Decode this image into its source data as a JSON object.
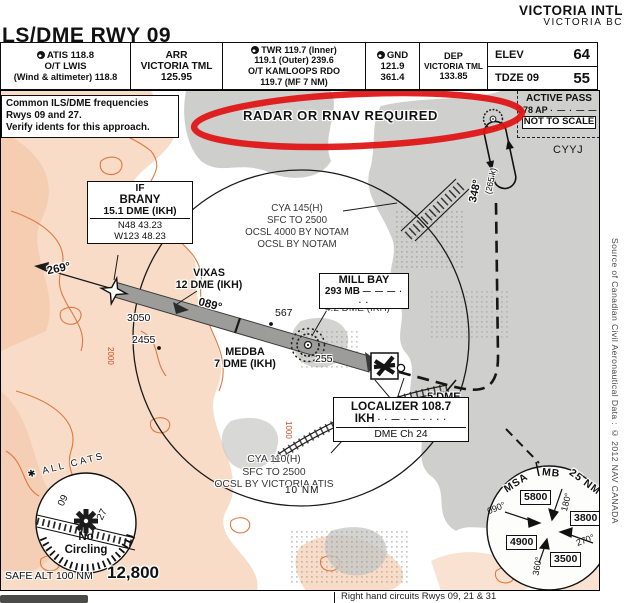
{
  "colors": {
    "terrain": "#f8dcc7",
    "terrain_contour": "#df7940",
    "water": "#c8c8c6",
    "annotation_red": "#e01212",
    "ink": "#111111"
  },
  "header": {
    "airport": "VICTORIA INTL",
    "city": "VICTORIA BC",
    "title": "LS/DME RWY 09",
    "atis": [
      "ATIS 118.8",
      "O/T LWIS",
      "(Wind & altimeter) 118.8"
    ],
    "arr": [
      "ARR",
      "VICTORIA TML",
      "125.95"
    ],
    "twr": [
      "TWR  119.7 (Inner)",
      "119.1 (Outer)  239.6",
      "O/T KAMLOOPS RDO",
      "119.7 (MF 7 NM)"
    ],
    "gnd": [
      "GND",
      "121.9",
      "361.4"
    ],
    "dep": [
      "DEP",
      "VICTORIA TML",
      "133.85"
    ],
    "elev_label": "ELEV",
    "elev_value": "64",
    "tdze_label": "TDZE 09",
    "tdze_value": "55"
  },
  "map": {
    "freq_note": [
      "Common ILS/DME frequencies",
      "Rwys 09 and 27.",
      "Verify idents for this approach."
    ],
    "radar_note": "RADAR OR RNAV REQUIRED",
    "active_pass": {
      "name": "ACTIVE PASS",
      "ident": "378 AP",
      "morse": "· —  · — — ·",
      "scale_note": "NOT TO SCALE"
    },
    "airport_code": "CYYJ",
    "hold_course": "348°",
    "hold_speed": "(265 k)",
    "if_box": {
      "l1": "IF",
      "l2": "BRANY",
      "l3": "15.1 DME (IKH)",
      "lat": "N48 43.23",
      "lon": "W123 48.23"
    },
    "cya145": [
      "CYA 145(H)",
      "SFC TO 2500",
      "OCSL 4000 BY NOTAM",
      "OCSL BY NOTAM"
    ],
    "vixas": [
      "VIXAS",
      "12 DME (IKH)"
    ],
    "crs_out": "269°",
    "crs_in": "089°",
    "millbay": {
      "name": "MILL BAY",
      "ident": "293 MB",
      "morse": "— —  — · · ·",
      "dme": "4.2 DME (IKH)"
    },
    "medba": [
      "MEDBA",
      "7 DME (IKH)"
    ],
    "spots": {
      "s3050": "3050",
      "s2455": "2455",
      "s567": "567",
      "s255": "255"
    },
    "contours": {
      "c2000": "2000",
      "c1000": "1000"
    },
    "loc_box": {
      "l1": "LOCALIZER 108.7",
      "ident": "IKH",
      "morse": "· ·  — · —  · · · ·",
      "dme": "DME Ch 24"
    },
    "five_dme": "5 DME",
    "cya110": [
      "CYA 110(H)",
      "SFC TO 2500",
      "OCSL BY VICTORIA ATIS"
    ],
    "ring": "10 NM",
    "circling": {
      "cats": "✱ ALL  CATS",
      "r1": "09",
      "r2": "27",
      "no1": "No",
      "no2": "Circling"
    },
    "safe_alt_label": "SAFE ALT 100 NM",
    "safe_alt_value": "12,800",
    "msa": {
      "t1": "MSA",
      "t2": "MB",
      "t3": "25 NM",
      "nw": "5800",
      "e": "3800",
      "sw": "4900",
      "s": "3500",
      "b090": "090°",
      "b180": "180°",
      "b270": "270°",
      "b360": "360°"
    }
  },
  "footer": {
    "source": "Source of Canadian Civil Aeronautical Data : © 2012 NAV CANADA",
    "circuits": "Right hand circuits Rwys 09, 21 & 31"
  },
  "icons": {
    "comm": "phone-icon",
    "ndb": "ndb-icon",
    "waypoint": "waypoint-icon",
    "airport": "airport-icon",
    "star": "circling-star-icon"
  }
}
